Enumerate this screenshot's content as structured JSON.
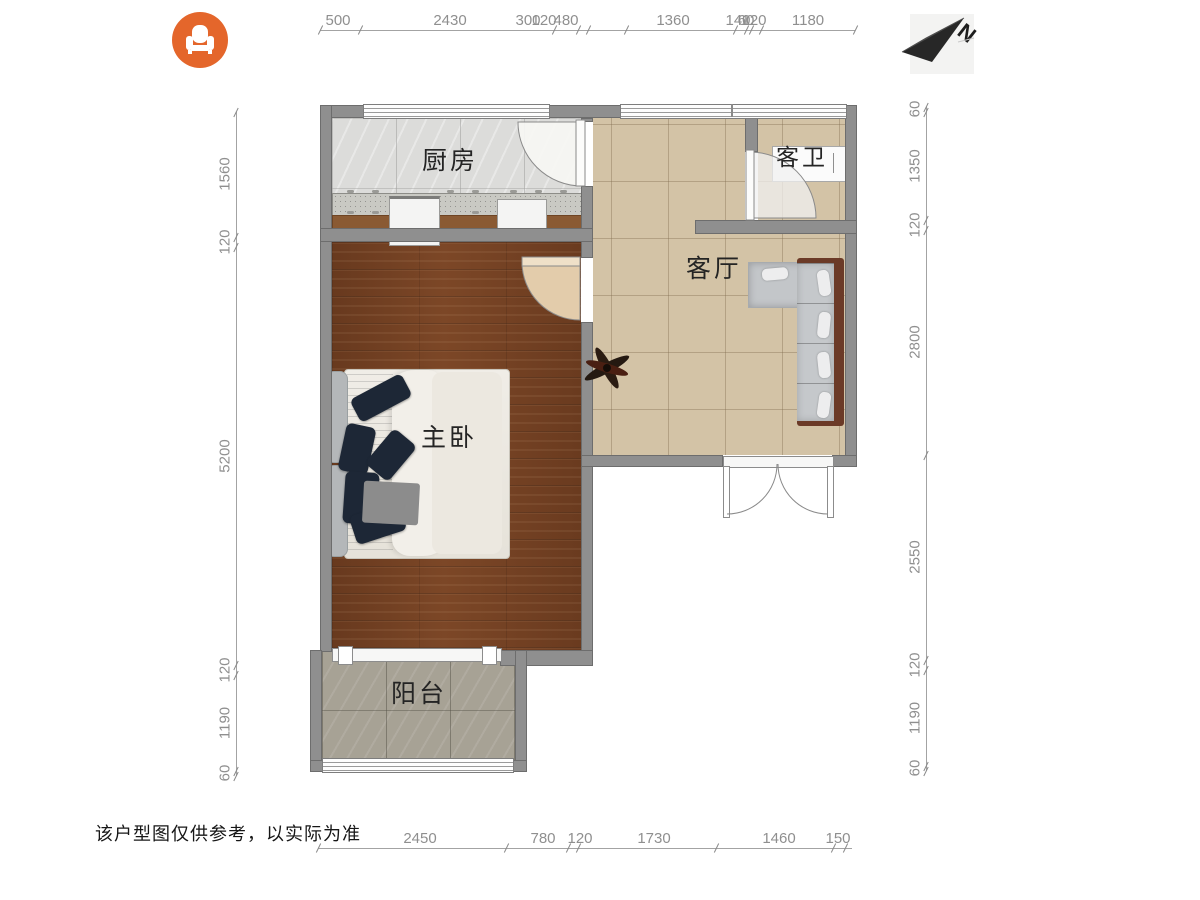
{
  "page": {
    "disclaimer": "该户型图仅供参考，以实际为准"
  },
  "logo": {
    "icon": "armchair-icon",
    "bg_color": "#E4662B"
  },
  "compass": {
    "label": "N"
  },
  "rooms": {
    "kitchen": "厨房",
    "bathroom": "客卫",
    "living": "客厅",
    "bedroom": "主卧",
    "balcony": "阳台"
  },
  "colors": {
    "accent_orange": "#E4662B",
    "wall_gray": "#8F8F8F",
    "wood_floor": "#7A4526",
    "tile_tan": "#D3C3A6",
    "balcony_stone": "#A7A295",
    "sofa_frame": "#6B3A27",
    "pillow_navy": "#1D2736",
    "dim_text": "#8F8F8F"
  },
  "dims": {
    "top": {
      "line": {
        "x1": 320,
        "x2": 855,
        "y": 30
      },
      "ticks": [
        320,
        360,
        554,
        578,
        588,
        626,
        735,
        746,
        751,
        761,
        855
      ],
      "labels": [
        {
          "v": "500",
          "x": 338
        },
        {
          "v": "2430",
          "x": 450
        },
        {
          "v": "300",
          "x": 528
        },
        {
          "v": "120",
          "x": 544
        },
        {
          "v": "480",
          "x": 566
        },
        {
          "v": "1360",
          "x": 673
        },
        {
          "v": "140",
          "x": 738
        },
        {
          "v": "60",
          "x": 746
        },
        {
          "v": "120",
          "x": 754
        },
        {
          "v": "1180",
          "x": 808
        }
      ]
    },
    "bottom": {
      "line": {
        "x1": 318,
        "x2": 852,
        "y": 848
      },
      "ticks": [
        318,
        506,
        568,
        578,
        716,
        833,
        845
      ],
      "labels": [
        {
          "v": "2450",
          "x": 420
        },
        {
          "v": "780",
          "x": 543
        },
        {
          "v": "120",
          "x": 580
        },
        {
          "v": "1730",
          "x": 654
        },
        {
          "v": "1460",
          "x": 779
        },
        {
          "v": "150",
          "x": 838
        }
      ]
    },
    "left": {
      "line": {
        "x": 236,
        "y1": 112,
        "y2": 776
      },
      "ticks": [
        112,
        237,
        247,
        665,
        675,
        771,
        776
      ],
      "labels": [
        {
          "v": "1560",
          "y": 174
        },
        {
          "v": "120",
          "y": 242
        },
        {
          "v": "5200",
          "y": 456
        },
        {
          "v": "120",
          "y": 670
        },
        {
          "v": "1190",
          "y": 723
        },
        {
          "v": "60",
          "y": 773
        }
      ]
    },
    "right": {
      "line": {
        "x": 926,
        "y1": 107,
        "y2": 771
      },
      "ticks": [
        107,
        112,
        220,
        230,
        455,
        660,
        670,
        766,
        771
      ],
      "labels": [
        {
          "v": "60",
          "y": 109
        },
        {
          "v": "1350",
          "y": 166
        },
        {
          "v": "120",
          "y": 225
        },
        {
          "v": "2800",
          "y": 342
        },
        {
          "v": "2550",
          "y": 557
        },
        {
          "v": "120",
          "y": 665
        },
        {
          "v": "1190",
          "y": 718
        },
        {
          "v": "60",
          "y": 768
        }
      ]
    }
  }
}
